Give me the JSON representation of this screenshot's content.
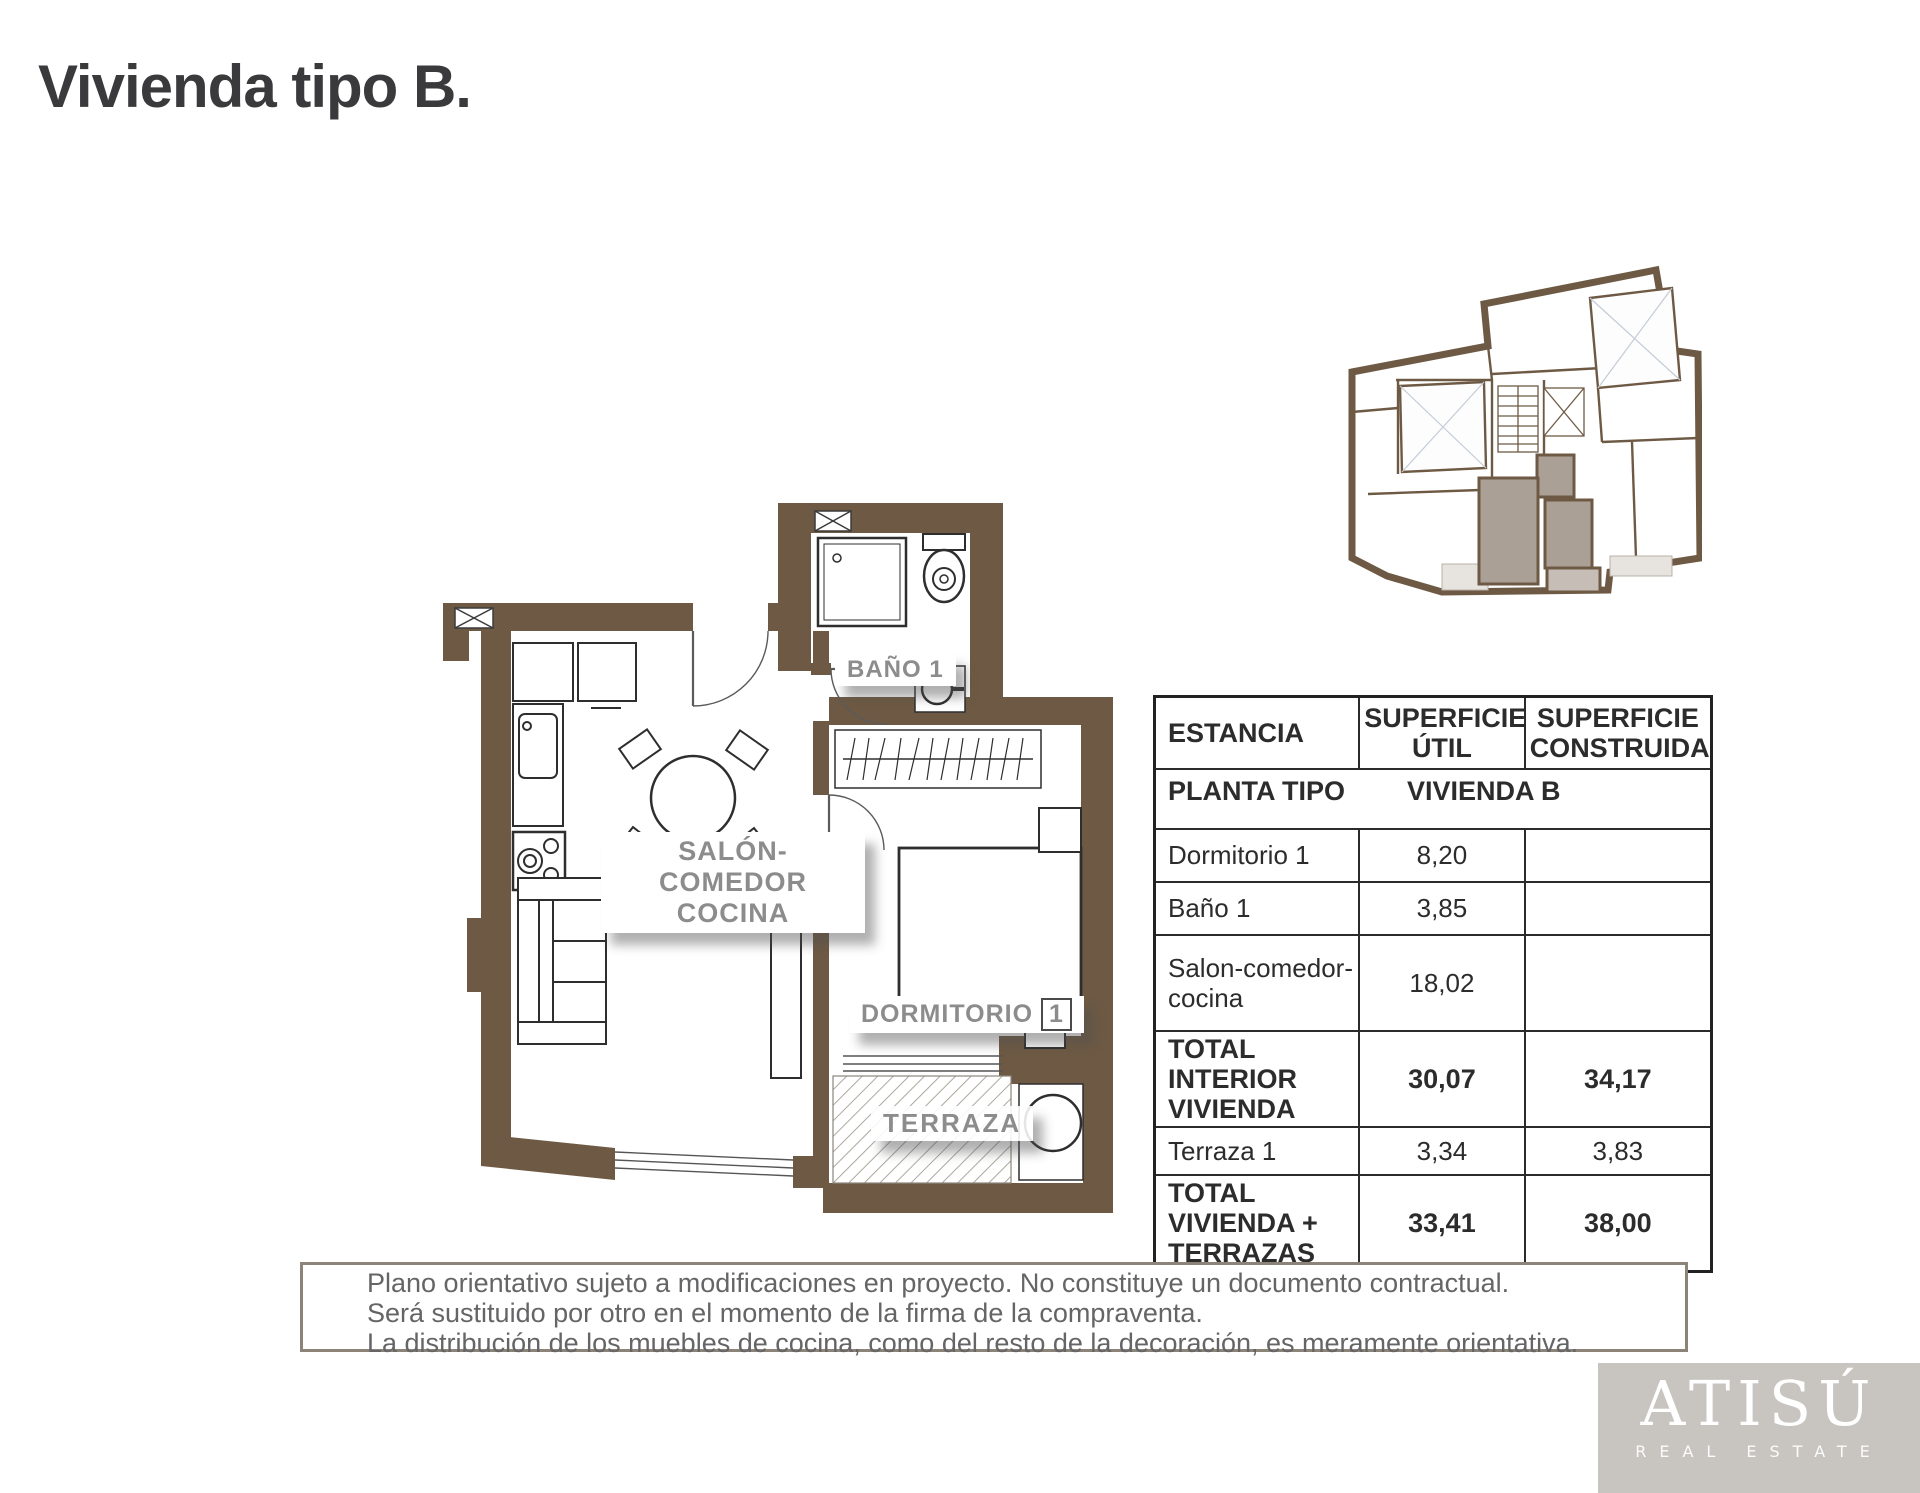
{
  "page": {
    "title": "Vivienda tipo B."
  },
  "floor_plan": {
    "labels": {
      "bathroom": "BAÑO 1",
      "living_line1": "SALÓN-COMEDOR",
      "living_line2": "COCINA",
      "bedroom": "DORMITORIO",
      "bedroom_num": "1",
      "terrace": "TERRAZA"
    },
    "colors": {
      "wall": "#6e5a44",
      "unit_highlight": "#aba096"
    }
  },
  "surface_table": {
    "headers": {
      "estancia": "ESTANCIA",
      "util": "SUPERFICIE ÚTIL",
      "construida": "SUPERFICIE CONSTRUIDA"
    },
    "subheader": {
      "label": "PLANTA TIPO",
      "value": "VIVIENDA B"
    },
    "rows": [
      {
        "estancia": "Dormitorio 1",
        "util": "8,20",
        "construida": ""
      },
      {
        "estancia": "Baño 1",
        "util": "3,85",
        "construida": ""
      },
      {
        "estancia": "Salon-comedor-cocina",
        "util": "18,02",
        "construida": ""
      },
      {
        "estancia": "TOTAL INTERIOR VIVIENDA",
        "util": "30,07",
        "construida": "34,17"
      },
      {
        "estancia": "Terraza 1",
        "util": "3,34",
        "construida": "3,83"
      },
      {
        "estancia": "TOTAL VIVIENDA + TERRAZAS",
        "util": "33,41",
        "construida": "38,00"
      }
    ]
  },
  "disclaimer": {
    "line1": "Plano orientativo sujeto a modificaciones en proyecto. No constituye un documento contractual.",
    "line2": "Será sustituido por otro en el momento de la firma de la compraventa.",
    "line3": "La distribución de los muebles de cocina, como del resto de la decoración, es meramente orientativa."
  },
  "logo": {
    "brand": "ATISÚ",
    "tagline": "REAL ESTATE"
  }
}
